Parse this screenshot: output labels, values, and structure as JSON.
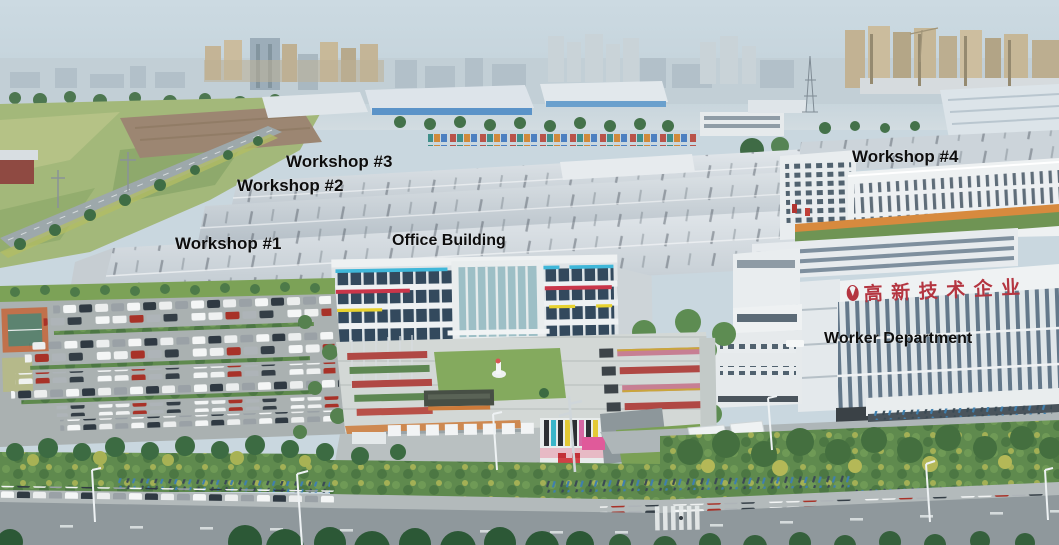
{
  "scene": {
    "title": "Aerial view of factory campus",
    "type": "annotated aerial photograph"
  },
  "annotations": {
    "workshop1": "Workshop #1",
    "workshop2": "Workshop #2",
    "workshop3": "Workshop #3",
    "workshop4": "Workshop #4",
    "office_building": "Office Building",
    "worker_department": "Worker Department"
  },
  "rooftop_sign": {
    "text": "高新技术企业",
    "color": "#b43540"
  },
  "palette": {
    "label_text": "#0d0d0d",
    "sky": "#c9d7df",
    "roof_light": "#d9dfe4",
    "office_accent_cyan": "#3fb7d9",
    "office_accent_red": "#c9364a",
    "office_accent_yellow": "#e8d22f",
    "orange_wall": "#d78a3e",
    "lawn_green": "#84aa5e"
  }
}
